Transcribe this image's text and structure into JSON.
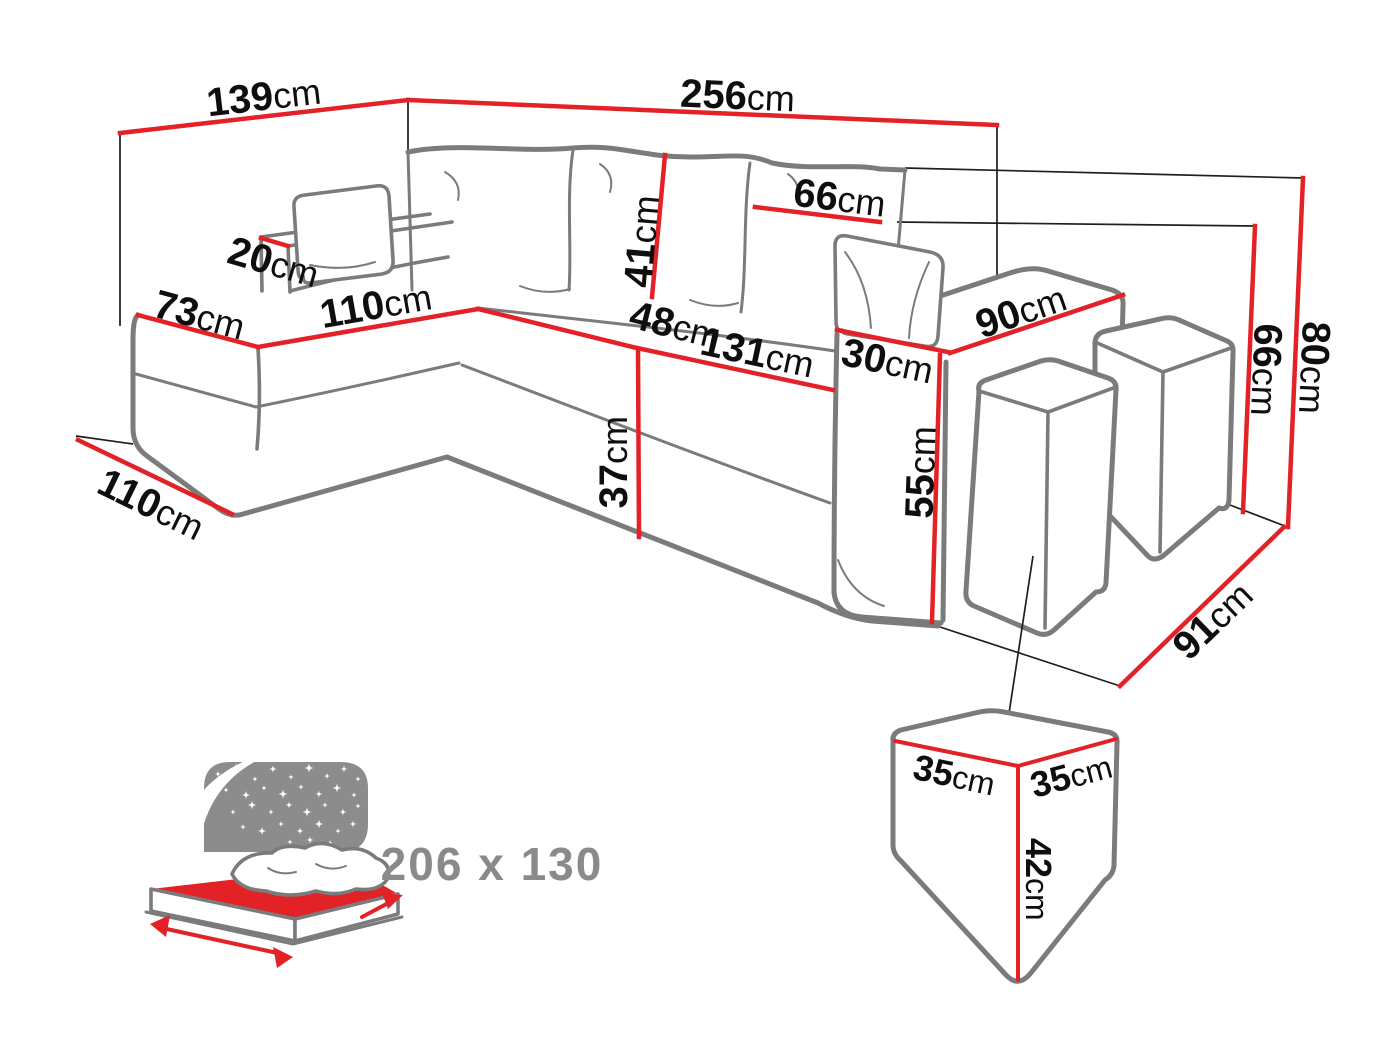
{
  "diagram_type": "corner-sofa dimension drawing",
  "dims": {
    "back_width_left": {
      "v": "139",
      "u": "cm"
    },
    "back_width_right": {
      "v": "256",
      "u": "cm"
    },
    "small_armrest_width": {
      "v": "20",
      "u": "cm"
    },
    "chaise_end_width": {
      "v": "73",
      "u": "cm"
    },
    "chaise_length": {
      "v": "110",
      "u": "cm"
    },
    "back_cushion_height": {
      "v": "41",
      "u": "cm"
    },
    "back_cushion_width": {
      "v": "66",
      "u": "cm"
    },
    "seat_depth": {
      "v": "48",
      "u": "cm"
    },
    "seat_width": {
      "v": "131",
      "u": "cm"
    },
    "armrest_width": {
      "v": "30",
      "u": "cm"
    },
    "armrest_depth": {
      "v": "90",
      "u": "cm"
    },
    "seat_height": {
      "v": "37",
      "u": "cm"
    },
    "armrest_height": {
      "v": "55",
      "u": "cm"
    },
    "height_to_armrest": {
      "v": "66",
      "u": "cm"
    },
    "total_height": {
      "v": "80",
      "u": "cm"
    },
    "chaise_floor_depth": {
      "v": "110",
      "u": "cm"
    },
    "sofa_floor_depth": {
      "v": "91",
      "u": "cm"
    }
  },
  "pouf": {
    "top_width_left": {
      "v": "35",
      "u": "cm"
    },
    "top_width_right": {
      "v": "35",
      "u": "cm"
    },
    "height": {
      "v": "42",
      "u": "cm"
    }
  },
  "sleeping_area": {
    "size_label": "206 x 130"
  },
  "colors": {
    "dimension_red": "#e32227",
    "outline_gray": "#7b7b7b",
    "thin_line": "#1f1f1f",
    "text_black": "#0e0e0e",
    "icon_gray": "#8c8c8c",
    "text_gray": "#8a8a8a"
  }
}
